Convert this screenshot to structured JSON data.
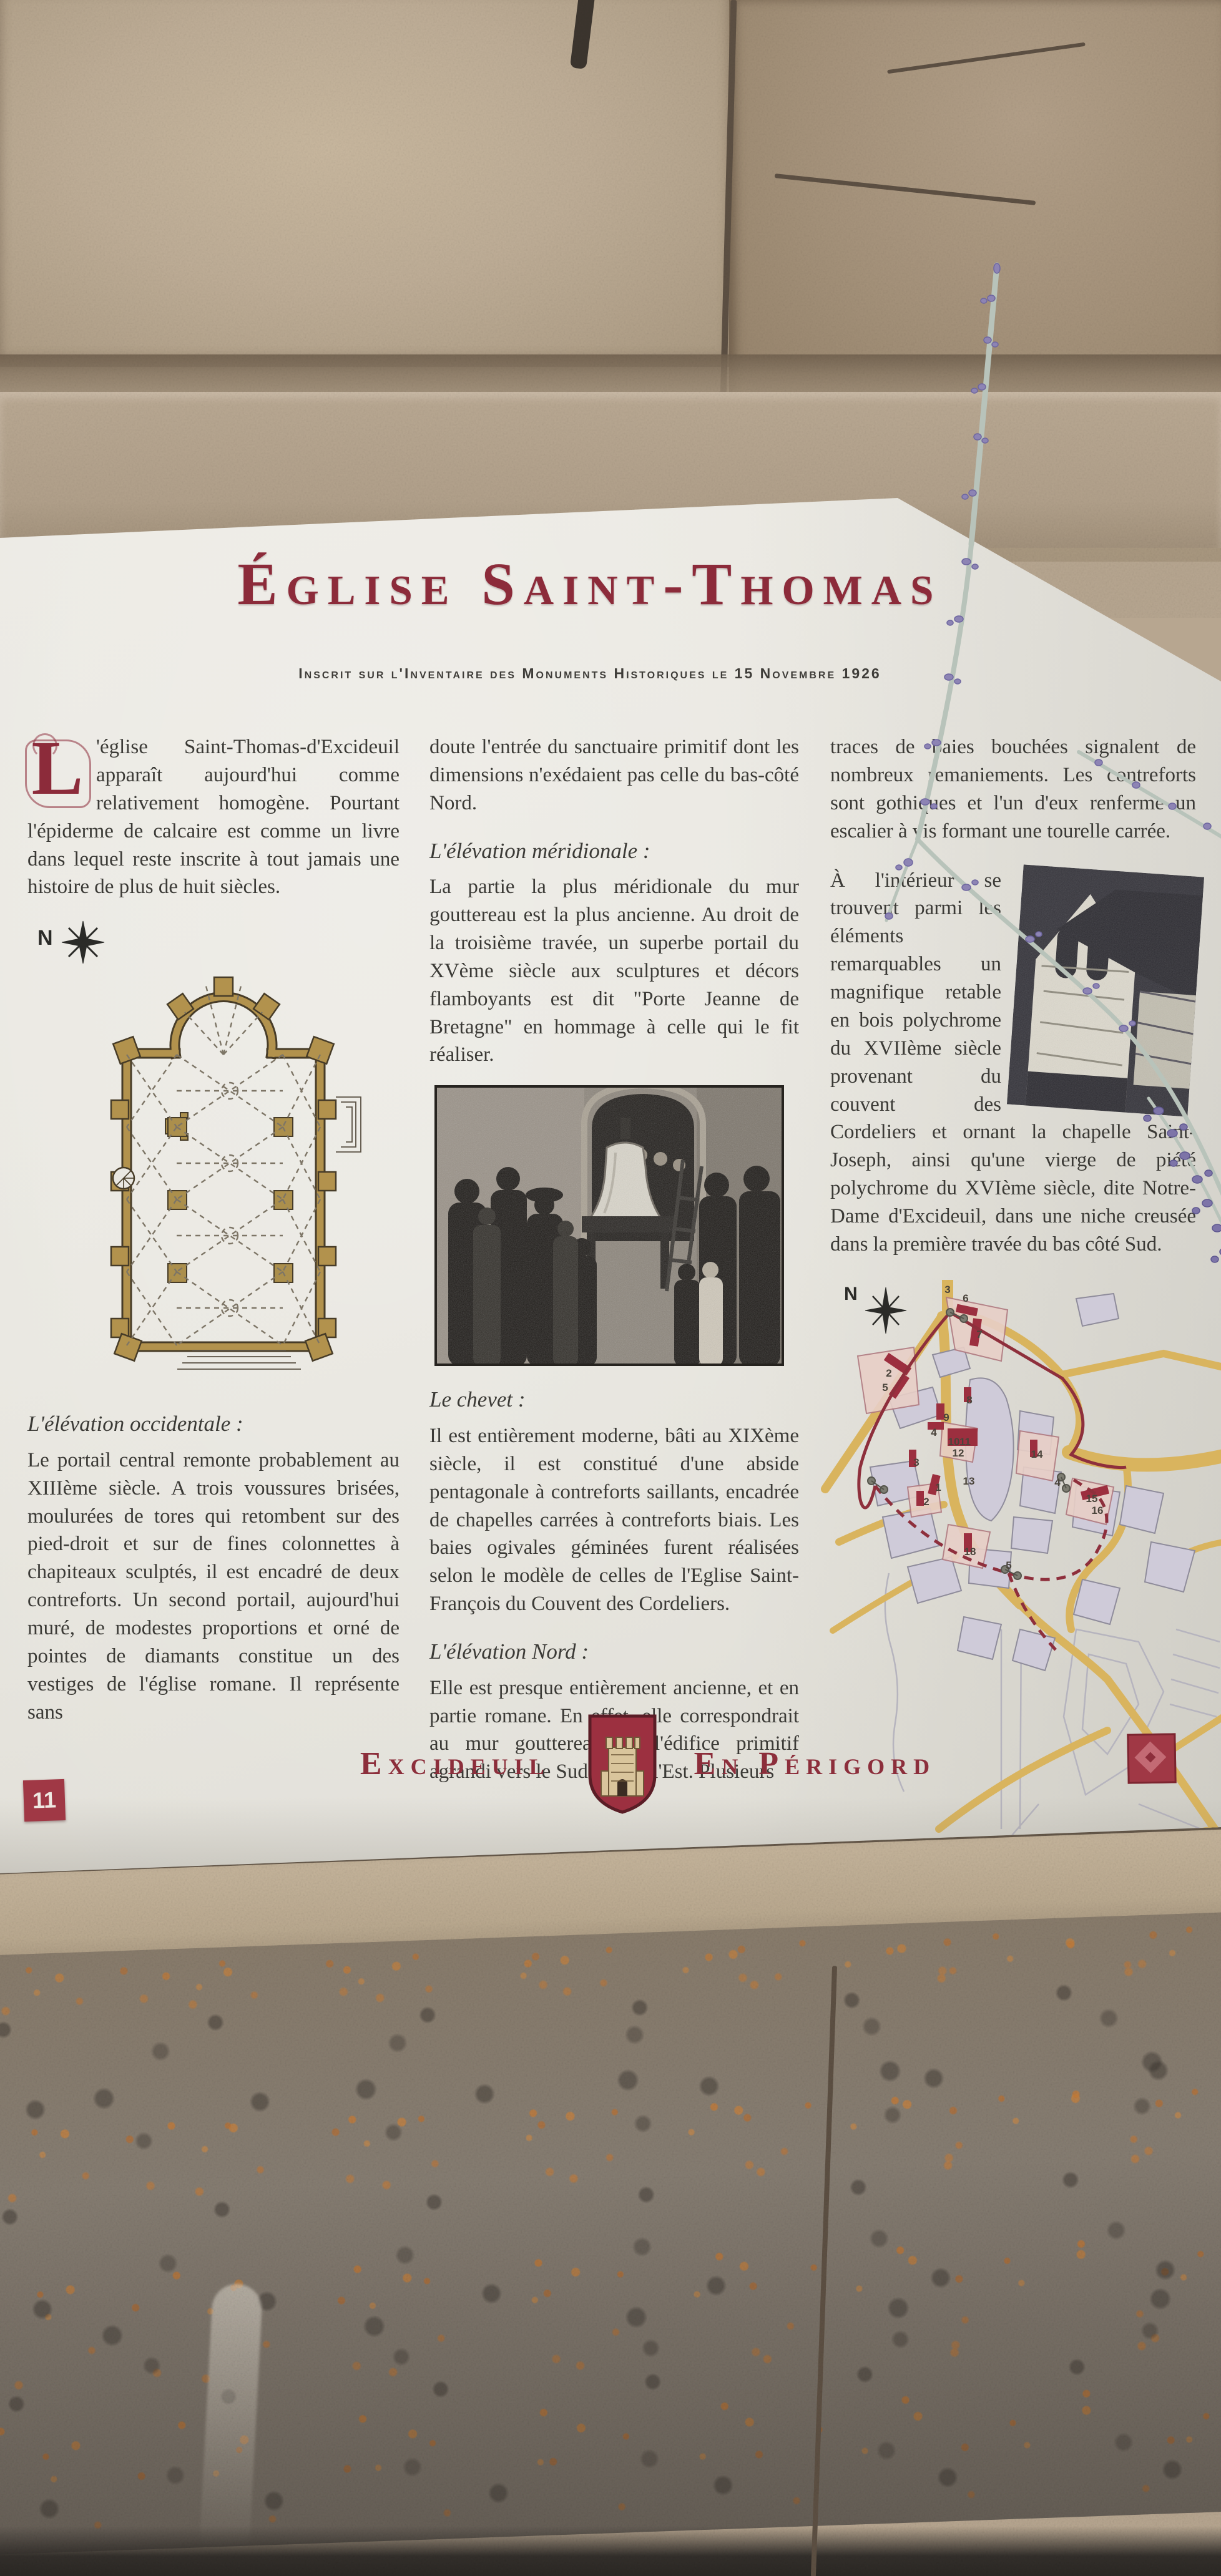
{
  "colors": {
    "accent": "#8c2b3a",
    "road": "#d9b45e",
    "monument": "#9c2f3f"
  },
  "sign": {
    "title": "Église Saint-Thomas",
    "subtitle": "Inscrit sur l'Inventaire des Monuments Historiques le 15 Novembre 1926",
    "intro": {
      "dropcap": "L",
      "text": "'église Saint-Thomas-d'Excideuil apparaît aujourd'hui comme relativement homogène. Pourtant l'épiderme de calcaire est comme un livre dans lequel reste inscrite à tout jamais une histoire de plus de huit siècles."
    },
    "col1": {
      "compass": "N",
      "heading": "L'élévation occidentale :",
      "para": "Le portail central remonte probablement au XIIIème siècle. A trois voussures brisées, moulurées de tores qui retombent sur des pied-droit et sur de fines colonnettes à chapiteaux sculptés, il est encadré de deux contreforts. Un second portail, aujourd'hui muré, de modestes proportions et orné de pointes de diamants constitue un des vestiges de l'église romane. Il représente sans"
    },
    "col2": {
      "para1": "doute l'entrée du sanctuaire primitif dont les dimensions n'exédaient pas celle du bas-côté Nord.",
      "heading1": "L'élévation méridionale :",
      "para2": "La partie la plus méridionale du mur gouttereau est la plus ancienne. Au droit de la troisième travée, un superbe portail du XVème siècle aux sculptures et décors flamboyants est dit \"Porte Jeanne de Bretagne\" en hommage à celle qui le fit réaliser.",
      "heading2": "Le chevet :",
      "para3": "Il est entièrement moderne, bâti au XIXème siècle, il est constitué d'une abside pentagonale à contreforts saillants, encadrée de chapelles carrées à contreforts biais. Les baies ogivales géminées furent réalisées selon le modèle de celles de l'Eglise Saint-François du Couvent des Cordeliers.",
      "heading3": "L'élévation Nord :",
      "para4": "Elle est presque entièrement ancienne, et en partie romane. En effet, elle correspondrait au mur gouttereau de l'édifice primitif agrandi vers le Sud et vers l'Est. Plusieurs"
    },
    "col3": {
      "para1": "traces de baies bouchées signalent de nombreux remaniements. Les contreforts sont gothiques et l'un d'eux renferme un escalier à vis formant une tourelle carrée.",
      "para2": "À l'intérieur se trouvent parmi les éléments remarquables un magnifique retable en bois polychrome du XVIIème siècle provenant du couvent des Cordeliers et ornant la chapelle Saint-Joseph, ainsi qu'une vierge de piété polychrome du XVIème siècle, dite Notre-Dame d'Excideuil, dans une niche creusée dans la première travée du bas côté Sud.",
      "compass": "N"
    },
    "footer": {
      "badge": "11",
      "town": "Excideuil",
      "region": "En Périgord"
    }
  },
  "map": {
    "markers": [
      "3",
      "6",
      "7",
      "2",
      "5",
      "9",
      "4",
      "8",
      "10",
      "11",
      "12",
      "3",
      "13",
      "1",
      "2",
      "14",
      "4",
      "15",
      "16",
      "18",
      "5"
    ]
  }
}
